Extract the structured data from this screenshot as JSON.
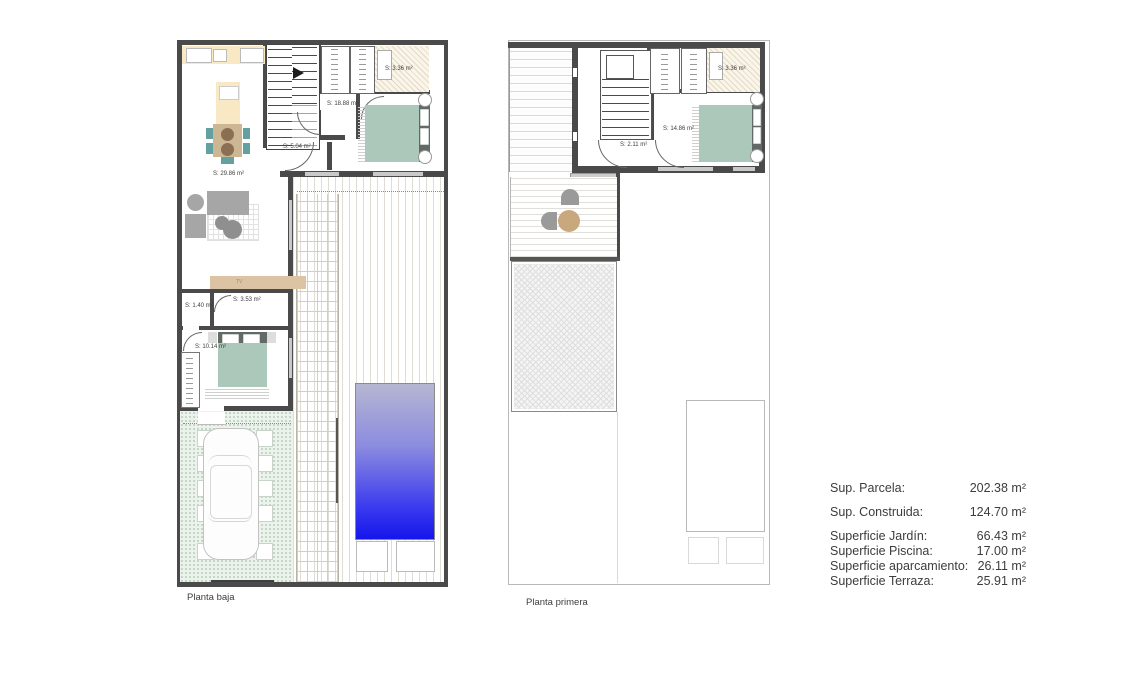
{
  "plans": [
    {
      "label": "Planta baja",
      "tv_label": "TV",
      "rooms": [
        {
          "name": "salon-cocina",
          "label": "S: 29.86 m²"
        },
        {
          "name": "distribuidor",
          "label": "S: 18.88 m²"
        },
        {
          "name": "hall",
          "label": "S: 5.04 m²"
        },
        {
          "name": "armario",
          "label": "S: 3.36 m²"
        },
        {
          "name": "aseo-hall",
          "label": "S: 1.40 m²"
        },
        {
          "name": "bano",
          "label": "S: 3.53 m²"
        },
        {
          "name": "dormitorio",
          "label": "S: 10.14 m²"
        }
      ]
    },
    {
      "label": "Planta primera",
      "rooms": [
        {
          "name": "hall",
          "label": "S: 2.11 m²"
        },
        {
          "name": "dormitorio",
          "label": "S: 14.86 m²"
        },
        {
          "name": "armario",
          "label": "S: 3.36 m²"
        }
      ]
    }
  ],
  "summary": {
    "rows": [
      {
        "label": "Sup. Parcela:",
        "value": "202.38 m²"
      },
      {
        "label": "Sup. Construida:",
        "value": "124.70 m²"
      },
      {
        "label": "Superficie Jardín:",
        "value": "66.43 m²"
      },
      {
        "label": "Superficie Piscina:",
        "value": "17.00 m²"
      },
      {
        "label": "Superficie aparcamiento:",
        "value": "26.11 m²"
      },
      {
        "label": "Superficie Terraza:",
        "value": "25.91 m²"
      }
    ]
  },
  "colors": {
    "wall": "#4a4a4a",
    "pool_top": "#b6b6d2",
    "pool_bottom": "#1515ec",
    "bed": "#abc8bb",
    "chair_teal": "#63a0a0",
    "kitchen_counter": "#f8e9c4",
    "wood": "#cdb694",
    "tv_console": "#dcc3a4",
    "sofa": "#a6a6a6",
    "garden": "#ecf2ec",
    "terrace_table": "#c8a87c"
  }
}
